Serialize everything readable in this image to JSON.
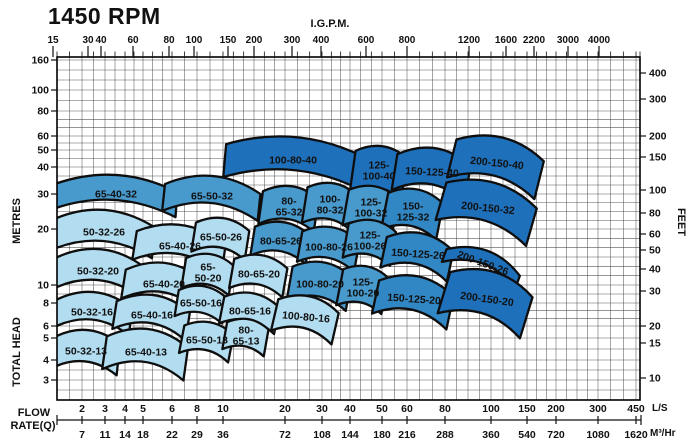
{
  "page": {
    "title": "1450 RPM",
    "top_axis_label": "I.G.P.M.",
    "left_axis_label_upper": "METRES",
    "left_axis_label_lower": "TOTAL HEAD",
    "right_axis_label": "FEET",
    "flow_label_line1": "FLOW",
    "flow_label_line2": "RATE(Q)",
    "unit_ls": "L/S",
    "unit_m3hr": "M³/Hr"
  },
  "colors": {
    "dark": "#1e70bb",
    "middark": "#3186c4",
    "medium": "#4899cc",
    "light": "#b2ddf0",
    "outline": "#0e0e0e",
    "grid": "#3c3c3c",
    "border": "#000000",
    "label_on_light": "#16314a",
    "label_on_dark": "#ffffff"
  },
  "chart_data": {
    "type": "area",
    "title": "1450 RPM",
    "description": "Pump model selection envelopes plotted on log-log head vs flow grid",
    "top_axis": {
      "label": "I.G.P.M.",
      "ticks": [
        [
          "15",
          53
        ],
        [
          "30",
          88
        ],
        [
          "40",
          101
        ],
        [
          "60",
          133
        ],
        [
          "80",
          169
        ],
        [
          "100",
          194
        ],
        [
          "150",
          228
        ],
        [
          "200",
          254
        ],
        [
          "300",
          292
        ],
        [
          "400",
          321
        ],
        [
          "600",
          366
        ],
        [
          "800",
          407
        ],
        [
          "1200",
          469
        ],
        [
          "1600",
          506
        ],
        [
          "2200",
          534
        ],
        [
          "3000",
          568
        ],
        [
          "4000",
          599
        ]
      ]
    },
    "left_axis": {
      "labels": [
        "METRES",
        "TOTAL HEAD"
      ],
      "ticks": [
        [
          "160",
          60
        ],
        [
          "100",
          90
        ],
        [
          "80",
          111
        ],
        [
          "60",
          136
        ],
        [
          "50",
          150
        ],
        [
          "40",
          167
        ],
        [
          "30",
          194
        ],
        [
          "20",
          229
        ],
        [
          "10",
          285
        ],
        [
          "8",
          303
        ],
        [
          "6",
          326
        ],
        [
          "5",
          338
        ],
        [
          "4",
          360
        ],
        [
          "3",
          380
        ]
      ]
    },
    "right_axis": {
      "label": "FEET",
      "ticks": [
        [
          "400",
          73
        ],
        [
          "300",
          99
        ],
        [
          "200",
          136
        ],
        [
          "150",
          157
        ],
        [
          "100",
          190
        ],
        [
          "80",
          213
        ],
        [
          "60",
          234
        ],
        [
          "50",
          250
        ],
        [
          "40",
          269
        ],
        [
          "30",
          291
        ],
        [
          "20",
          326
        ],
        [
          "15",
          343
        ],
        [
          "10",
          378
        ]
      ]
    },
    "bottom_axis": {
      "label": [
        "FLOW",
        "RATE(Q)"
      ],
      "units": [
        "L/S",
        "M³/Hr"
      ],
      "ticks": [
        [
          "2",
          "7",
          82
        ],
        [
          "3",
          "11",
          105
        ],
        [
          "4",
          "14",
          125
        ],
        [
          "5",
          "18",
          143
        ],
        [
          "6",
          "22",
          172
        ],
        [
          "8",
          "29",
          197
        ],
        [
          "10",
          "36",
          223
        ],
        [
          "20",
          "72",
          285
        ],
        [
          "30",
          "108",
          322
        ],
        [
          "40",
          "144",
          350
        ],
        [
          "50",
          "180",
          382
        ],
        [
          "60",
          "216",
          407
        ],
        [
          "80",
          "288",
          445
        ],
        [
          "100",
          "360",
          491
        ],
        [
          "150",
          "540",
          527
        ],
        [
          "200",
          "720",
          556
        ],
        [
          "300",
          "1080",
          598
        ],
        [
          "450",
          "1620",
          636
        ]
      ]
    },
    "regions": [
      {
        "label": "100-80-40",
        "cx": 293,
        "cy": 160,
        "w": 136,
        "h": 46,
        "rot": 5,
        "shade": "dark"
      },
      {
        "label": "125-100-40",
        "lines": [
          "125-",
          "100-40"
        ],
        "cx": 379,
        "cy": 171,
        "w": 52,
        "h": 50,
        "rot": 8,
        "shade": "dark"
      },
      {
        "label": "150-125-40",
        "cx": 432,
        "cy": 172,
        "w": 74,
        "h": 48,
        "rot": 9,
        "lrot": 3,
        "shade": "dark"
      },
      {
        "label": "200-150-40",
        "cx": 497,
        "cy": 163,
        "w": 90,
        "h": 52,
        "rot": 14,
        "lrot": 6,
        "shade": "dark"
      },
      {
        "label": "65-40-32",
        "cx": 116,
        "cy": 194,
        "w": 122,
        "h": 38,
        "rot": 4,
        "shade": "medium"
      },
      {
        "label": "65-50-32",
        "cx": 212,
        "cy": 196,
        "w": 96,
        "h": 40,
        "rot": 6,
        "shade": "medium"
      },
      {
        "label": "80-65-32",
        "lines": [
          "80-",
          "65-32"
        ],
        "cx": 289,
        "cy": 207,
        "w": 56,
        "h": 42,
        "rot": 8,
        "shade": "medium"
      },
      {
        "label": "100-80-32",
        "lines": [
          "100-",
          "80-32"
        ],
        "cx": 330,
        "cy": 205,
        "w": 50,
        "h": 44,
        "rot": 9,
        "shade": "medium"
      },
      {
        "label": "125-100-32",
        "lines": [
          "125-",
          "100-32"
        ],
        "cx": 371,
        "cy": 208,
        "w": 50,
        "h": 44,
        "rot": 10,
        "shade": "medium"
      },
      {
        "label": "150-125-32",
        "lines": [
          "150-",
          "125-32"
        ],
        "cx": 413,
        "cy": 212,
        "w": 56,
        "h": 46,
        "rot": 11,
        "shade": "middark"
      },
      {
        "label": "200-150-32",
        "cx": 488,
        "cy": 208,
        "w": 94,
        "h": 52,
        "rot": 16,
        "lrot": 6,
        "shade": "dark"
      },
      {
        "label": "50-32-26",
        "cx": 104,
        "cy": 232,
        "w": 100,
        "h": 44,
        "rot": 5,
        "shade": "light"
      },
      {
        "label": "65-40-26",
        "cx": 180,
        "cy": 246,
        "w": 90,
        "h": 42,
        "rot": 9,
        "shade": "light"
      },
      {
        "label": "65-50-26",
        "cx": 221,
        "cy": 237,
        "w": 54,
        "h": 38,
        "rot": 9,
        "shade": "light"
      },
      {
        "label": "80-65-26",
        "cx": 281,
        "cy": 241,
        "w": 56,
        "h": 38,
        "rot": 9,
        "shade": "medium"
      },
      {
        "label": "100-80-26",
        "cx": 329,
        "cy": 247,
        "w": 58,
        "h": 40,
        "rot": 10,
        "shade": "medium"
      },
      {
        "label": "125-100-26",
        "lines": [
          "125-",
          "100-26"
        ],
        "cx": 370,
        "cy": 241,
        "w": 48,
        "h": 42,
        "rot": 10,
        "shade": "medium"
      },
      {
        "label": "150-125-26",
        "cx": 418,
        "cy": 254,
        "w": 68,
        "h": 42,
        "rot": 12,
        "lrot": 4,
        "shade": "middark"
      },
      {
        "label": "200-150-26",
        "cx": 483,
        "cy": 263,
        "w": 78,
        "h": 26,
        "rot": 20,
        "lrot": 20,
        "shade": "dark"
      },
      {
        "label": "50-32-20",
        "cx": 98,
        "cy": 271,
        "w": 88,
        "h": 44,
        "rot": 5,
        "shade": "light"
      },
      {
        "label": "65-40-20",
        "cx": 164,
        "cy": 284,
        "w": 80,
        "h": 42,
        "rot": 9,
        "shade": "light"
      },
      {
        "label": "65-50-20",
        "lines": [
          "65-",
          "50-20"
        ],
        "cx": 208,
        "cy": 273,
        "w": 48,
        "h": 38,
        "rot": 9,
        "shade": "light"
      },
      {
        "label": "80-65-20",
        "cx": 259,
        "cy": 274,
        "w": 54,
        "h": 38,
        "rot": 10,
        "shade": "light"
      },
      {
        "label": "100-80-20",
        "cx": 320,
        "cy": 284,
        "w": 60,
        "h": 44,
        "rot": 10,
        "shade": "medium"
      },
      {
        "label": "125-100-20",
        "lines": [
          "125-",
          "100-20"
        ],
        "cx": 363,
        "cy": 288,
        "w": 46,
        "h": 44,
        "rot": 11,
        "shade": "medium"
      },
      {
        "label": "150-125-20",
        "cx": 414,
        "cy": 299,
        "w": 76,
        "h": 46,
        "rot": 12,
        "lrot": 4,
        "shade": "middark"
      },
      {
        "label": "200-150-20",
        "cx": 487,
        "cy": 299,
        "w": 86,
        "h": 56,
        "rot": 17,
        "lrot": 8,
        "shade": "dark"
      },
      {
        "label": "50-32-16",
        "cx": 92,
        "cy": 312,
        "w": 78,
        "h": 40,
        "rot": 5,
        "shade": "light"
      },
      {
        "label": "65-40-16",
        "cx": 152,
        "cy": 315,
        "w": 74,
        "h": 40,
        "rot": 9,
        "shade": "light"
      },
      {
        "label": "65-50-16",
        "cx": 201,
        "cy": 303,
        "w": 48,
        "h": 34,
        "rot": 9,
        "shade": "light"
      },
      {
        "label": "80-65-16",
        "cx": 250,
        "cy": 311,
        "w": 56,
        "h": 36,
        "rot": 11,
        "shade": "light"
      },
      {
        "label": "100-80-16",
        "cx": 306,
        "cy": 317,
        "w": 62,
        "h": 42,
        "rot": 13,
        "lrot": 5,
        "shade": "light"
      },
      {
        "label": "50-32-13",
        "cx": 86,
        "cy": 351,
        "w": 66,
        "h": 42,
        "rot": 6,
        "shade": "light"
      },
      {
        "label": "65-40-13",
        "cx": 146,
        "cy": 352,
        "w": 82,
        "h": 46,
        "rot": 8,
        "shade": "light"
      },
      {
        "label": "65-50-13",
        "cx": 207,
        "cy": 340,
        "w": 50,
        "h": 36,
        "rot": 11,
        "shade": "light"
      },
      {
        "label": "80-65-13",
        "lines": [
          "80-",
          "65-13"
        ],
        "cx": 246,
        "cy": 336,
        "w": 42,
        "h": 34,
        "rot": 10,
        "shade": "light"
      }
    ],
    "plot_area_px": {
      "left": 57,
      "top": 57,
      "right": 640,
      "bottom": 400
    }
  }
}
